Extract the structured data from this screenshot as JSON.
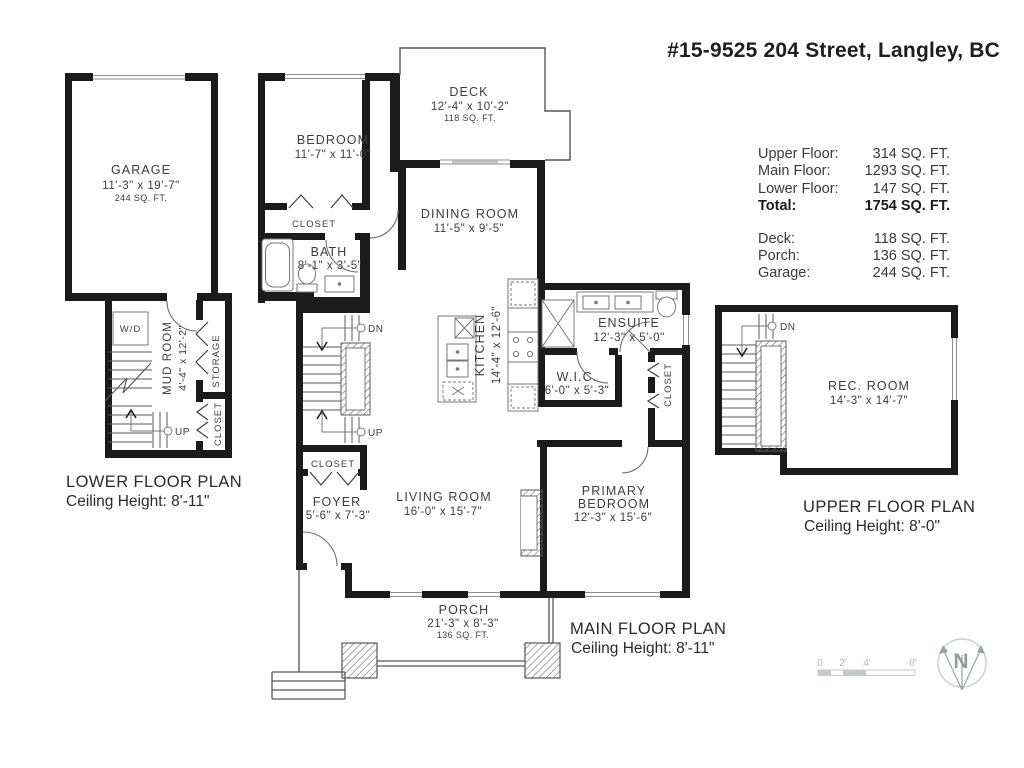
{
  "title": "#15-9525 204 Street, Langley, BC",
  "area_summary": {
    "main_rows": [
      {
        "label": "Upper Floor:",
        "value": "314 SQ. FT."
      },
      {
        "label": "Main Floor:",
        "value": "1293 SQ. FT."
      },
      {
        "label": "Lower Floor:",
        "value": "147 SQ. FT."
      },
      {
        "label": "Total:",
        "value": "1754 SQ. FT."
      }
    ],
    "extra_rows": [
      {
        "label": "Deck:",
        "value": "118 SQ. FT."
      },
      {
        "label": "Porch:",
        "value": "136 SQ. FT."
      },
      {
        "label": "Garage:",
        "value": "244 SQ. FT."
      }
    ]
  },
  "plans": {
    "lower": {
      "title": "LOWER FLOOR PLAN",
      "ceiling": "Ceiling Height: 8'-11\""
    },
    "main": {
      "title": "MAIN FLOOR PLAN",
      "ceiling": "Ceiling Height: 8'-11\""
    },
    "upper": {
      "title": "UPPER FLOOR PLAN",
      "ceiling": "Ceiling Height: 8'-0\""
    }
  },
  "rooms": {
    "garage": {
      "name": "GARAGE",
      "dims": "11'-3\" x 19'-7\"",
      "area": "244 SQ. FT."
    },
    "mud_room": {
      "name": "MUD ROOM",
      "dims": "4'-4\" x 12'-2\""
    },
    "bedroom": {
      "name": "BEDROOM",
      "dims": "11'-7\" x 11'-0\""
    },
    "deck": {
      "name": "DECK",
      "dims": "12'-4\" x 10'-2\"",
      "area": "118 SQ. FT."
    },
    "dining_room": {
      "name": "DINING ROOM",
      "dims": "11'-5\" x 9'-5\""
    },
    "bath": {
      "name": "BATH",
      "dims": "8'-1\" x 3'-5\""
    },
    "kitchen": {
      "name": "KITCHEN",
      "dims": "14'-4\" x 12'-6\""
    },
    "ensuite": {
      "name": "ENSUITE",
      "dims": "12'-3\" x 5'-0\""
    },
    "wic": {
      "name": "W.I.C.",
      "dims": "6'-0\" x 5'-3\""
    },
    "living_room": {
      "name": "LIVING ROOM",
      "dims": "16'-0\" x 15'-7\""
    },
    "primary_bedroom": {
      "name_line1": "PRIMARY",
      "name_line2": "BEDROOM",
      "dims": "12'-3\" x 15'-6\""
    },
    "foyer": {
      "name": "FOYER",
      "dims": "5'-6\" x 7'-3\""
    },
    "porch": {
      "name": "PORCH",
      "dims": "21'-3\" x 8'-3\"",
      "area": "136 SQ. FT."
    },
    "rec_room": {
      "name": "REC. ROOM",
      "dims": "14'-3\" x 14'-7\""
    }
  },
  "labels": {
    "closet": "CLOSET",
    "storage": "STORAGE",
    "wd": "W/D",
    "up": "UP",
    "dn": "DN"
  },
  "scale_bar": {
    "ticks": [
      "0",
      "2'",
      "4'",
      "8'"
    ]
  },
  "compass": {
    "letter": "N"
  }
}
